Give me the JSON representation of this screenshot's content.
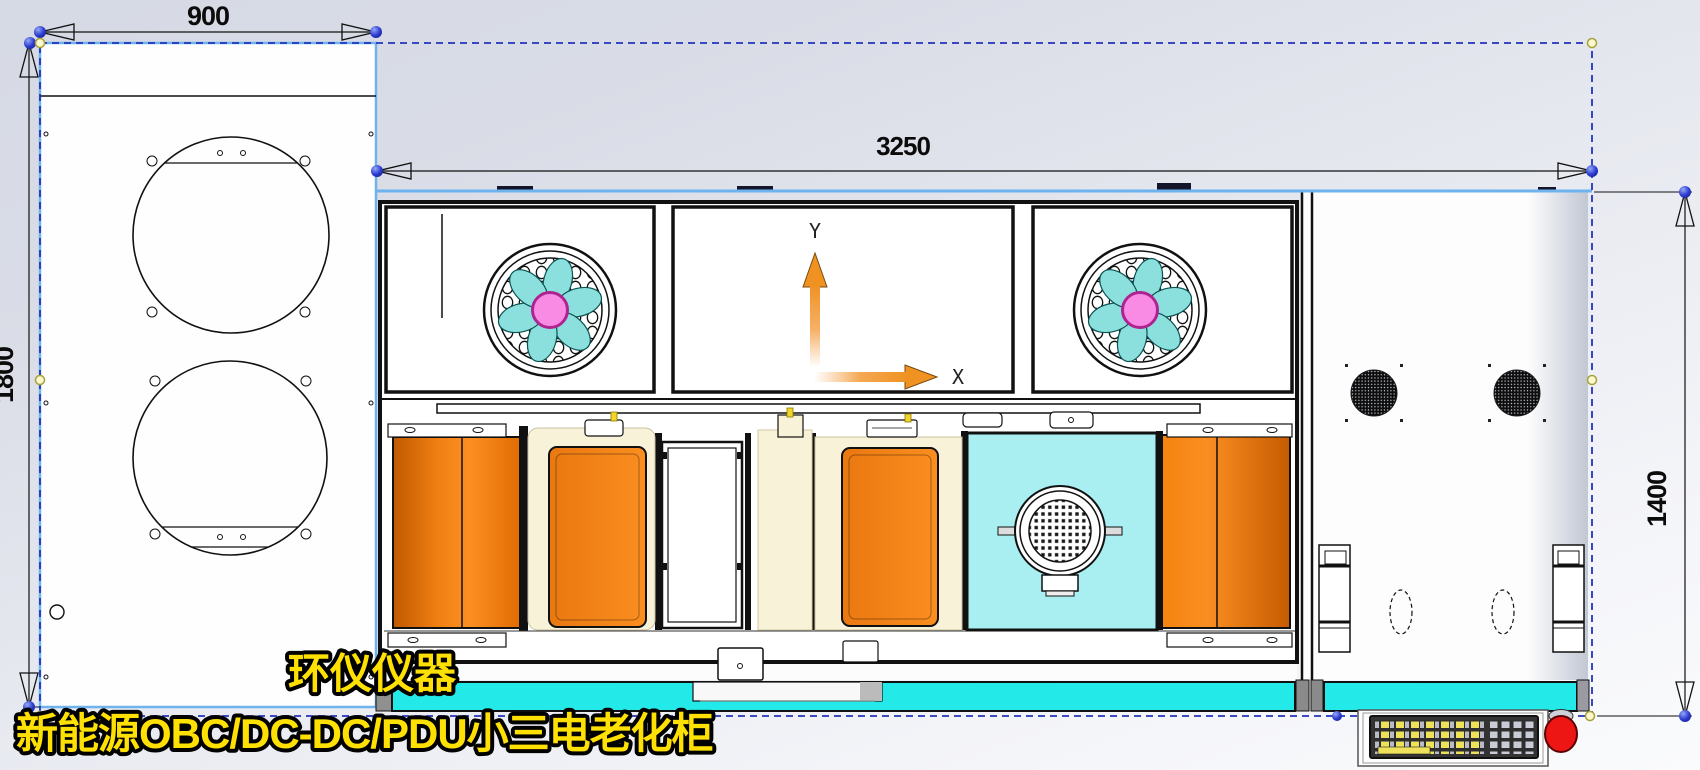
{
  "drawing": {
    "dimensions": {
      "side_view_width": "900",
      "side_view_height": "1800",
      "front_view_width": "3250",
      "front_view_height": "1400"
    },
    "axes": {
      "y_label": "Y",
      "x_label": "X"
    },
    "watermark": {
      "line1": "环仪仪器",
      "line2": "新能源OBC/DC-DC/PDU小三电老化柜"
    },
    "colors": {
      "door_orange": "#F5830F",
      "base_cyan": "#23E9E9",
      "panel_cyan": "#A9EFF1",
      "fan_blade_teal": "#8BE0DE",
      "fan_hub_pink": "#F98BE5",
      "watermark_yellow": "#FFE003",
      "selection_dash_blue": "#2233BB",
      "highlight_blue": "#6FB3EE",
      "endpoint_dot_blue": "#2B3BD0",
      "handle_dot_yellow": "#FBF7CE",
      "cream_panel": "#F8F2D9",
      "mouse_red": "#EE1515"
    }
  }
}
